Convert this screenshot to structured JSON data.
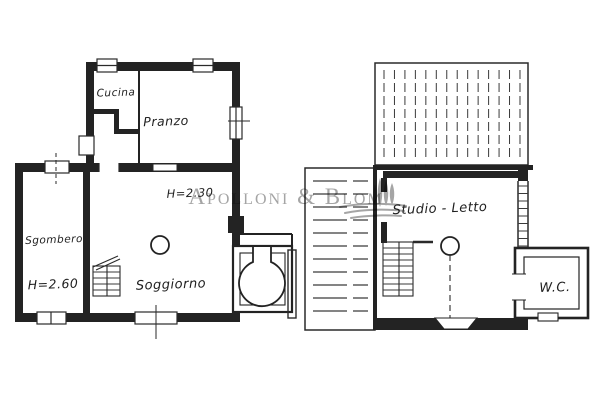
{
  "watermark": {
    "name": "Apolloni & Blom",
    "logo_icon": "wheat-sheaf-icon",
    "color": "#9b9b9b"
  },
  "floor_plans": {
    "ground_floor": {
      "rooms": [
        {
          "id": "cucina",
          "label": "Cucina"
        },
        {
          "id": "pranzo",
          "label": "Pranzo"
        },
        {
          "id": "sgombero",
          "label": "Sgombero"
        },
        {
          "id": "soggiorno",
          "label": "Soggiorno"
        }
      ],
      "annotations": [
        {
          "room": "soggiorno",
          "text": "H=2.30"
        },
        {
          "room": "sgombero",
          "text": "H=2.60"
        }
      ]
    },
    "first_floor": {
      "rooms": [
        {
          "id": "studio_letto",
          "label": "Studio - Letto"
        },
        {
          "id": "wc",
          "label": "W.C."
        }
      ]
    }
  },
  "colors": {
    "ink": "#232323",
    "paper": "#ffffff",
    "watermark_text": "#9b9b9b"
  }
}
